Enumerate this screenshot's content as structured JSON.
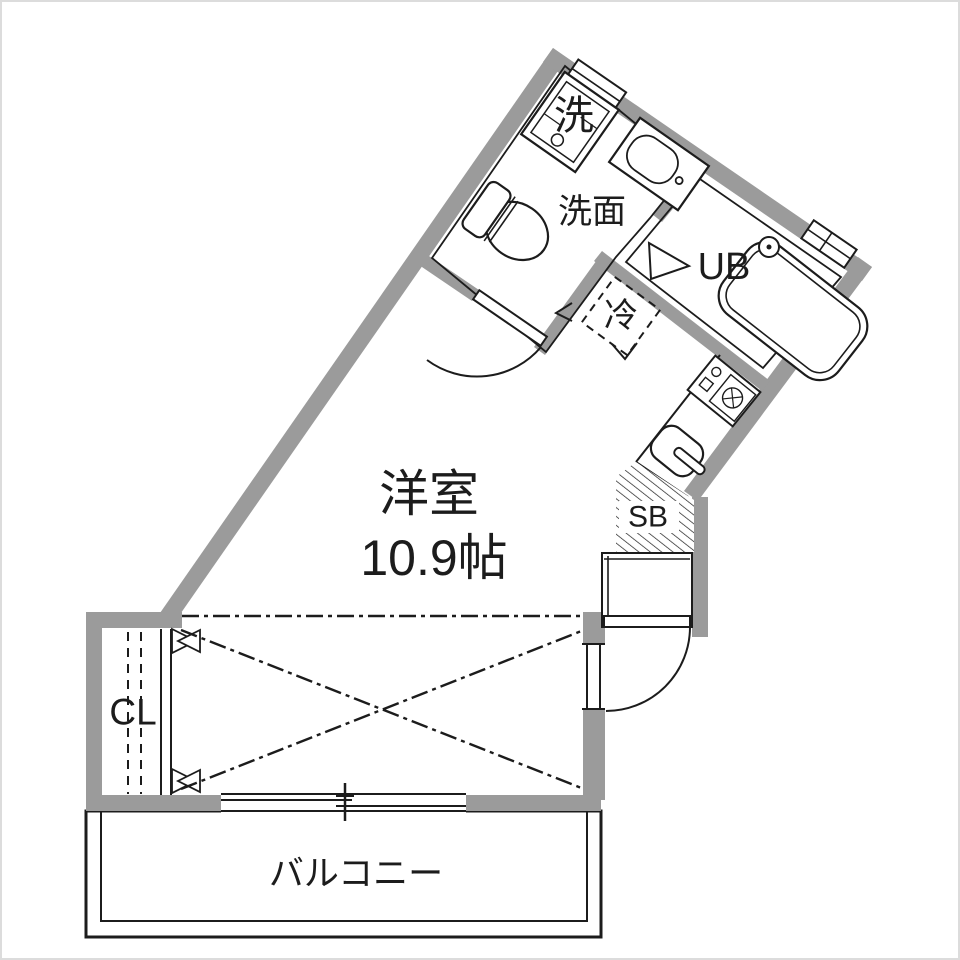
{
  "floorplan": {
    "type": "japanese-apartment-floor-plan",
    "colors": {
      "wall": "#9b9b9b",
      "line": "#1c1c1c",
      "background": "#ffffff"
    },
    "rooms": {
      "main_room": {
        "name": "洋室",
        "size": "10.9帖"
      },
      "washroom": {
        "label": "洗面"
      },
      "unit_bath": {
        "label": "UB"
      },
      "washing_machine": {
        "label": "洗"
      },
      "refrigerator": {
        "label": "冷"
      },
      "shoe_box": {
        "label": "SB"
      },
      "closet": {
        "label": "CL"
      },
      "balcony": {
        "label": "バルコニー"
      }
    }
  }
}
